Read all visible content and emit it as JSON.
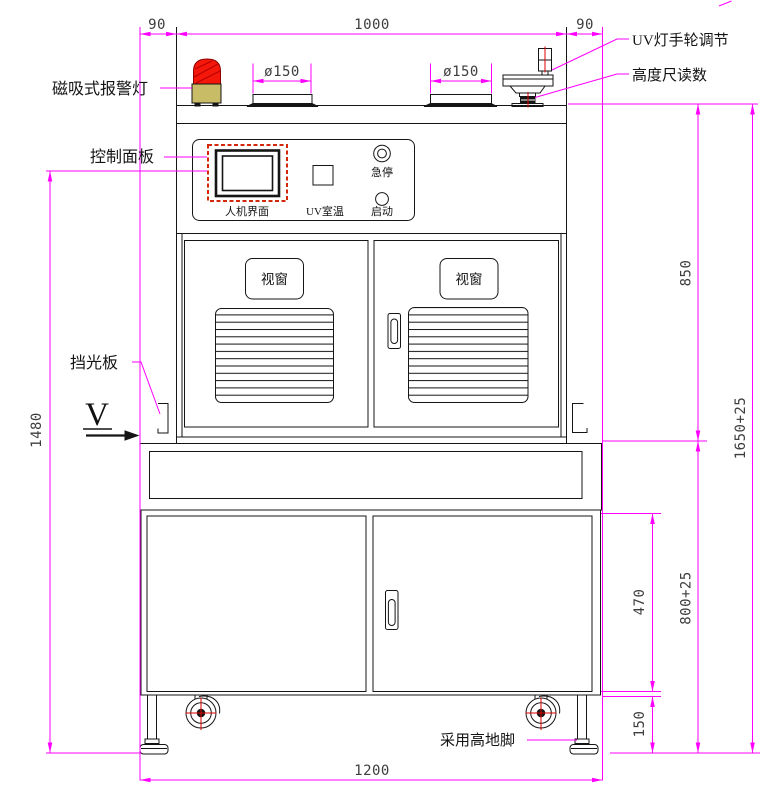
{
  "dimensions": {
    "top_left_offset": "90",
    "top_width": "1000",
    "top_right_offset": "90",
    "platform_dia_left": "ø150",
    "platform_dia_right": "ø150",
    "upper_cabinet_height": "850",
    "overall_height": "1650+25",
    "panel_height_from_floor": "1480",
    "lower_frame_height": "800+25",
    "lower_door_height": "470",
    "foot_height": "150",
    "base_width": "1200"
  },
  "callouts": {
    "alarm_light": "磁吸式报警灯",
    "control_panel": "控制面板",
    "uv_handwheel": "UV灯手轮调节",
    "height_gauge": "高度尺读数",
    "light_shield": "挡光板",
    "leveling_foot": "采用高地脚",
    "view_marker": "V"
  },
  "control_panel": {
    "hmi_label": "人机界面",
    "uv_temp_label": "UV室温",
    "estop_label": "急停",
    "start_label": "启动"
  },
  "doors": {
    "left_window_label": "视窗",
    "right_window_label": "视窗"
  },
  "colors": {
    "dimension_magenta": "#FF00FF",
    "outline_black": "#151515",
    "alarm_dome_red": "#F5180A",
    "alarm_base_khaki": "#C9BC66",
    "centerline_red": "#DD0000",
    "hmi_frame_red": "#D3270A"
  }
}
